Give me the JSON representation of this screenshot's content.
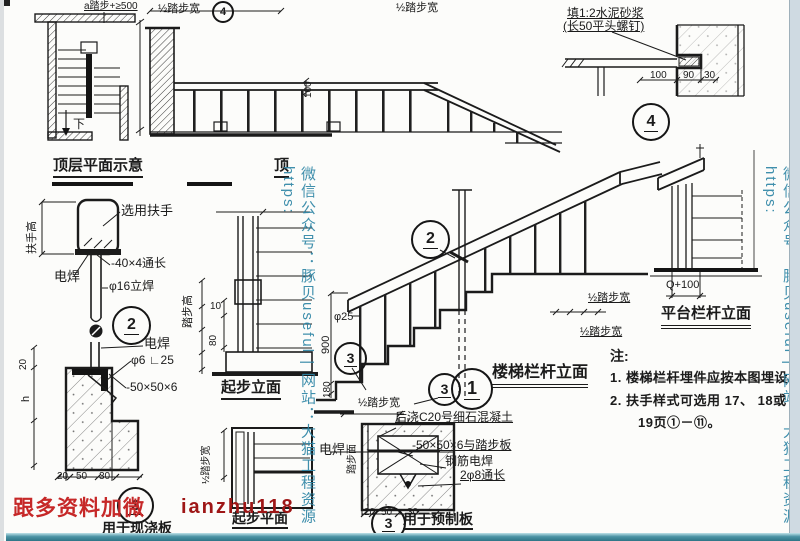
{
  "colors": {
    "ink": "#1b1b1b",
    "watermark_teal": "#2f86a6",
    "promo_red": "#c62828",
    "handle_red": "#9e1616",
    "bottom_bar": "#3f8496"
  },
  "watermark": {
    "text": "微信公众号：豚贝useful | 网站：大猫工程资源 https:"
  },
  "promo": {
    "text": "跟多资料加微",
    "handle": "ianzhu118"
  },
  "top_plan": {
    "title": "顶层平面示意",
    "note": "a踏步+≥500",
    "down": "下"
  },
  "top_elev": {
    "title": "顶",
    "tread_dim": "½踏步宽",
    "detail_ref": "4",
    "tread_dim2": "½踏步宽",
    "dim_100": "100"
  },
  "detail_4": {
    "ref": "4",
    "note_line1": "填1:2水泥砂浆",
    "note_line2": "(长50平头螺钉)",
    "dim_100": "100",
    "dim_90": "90",
    "dim_30": "30"
  },
  "detail_2": {
    "ref": "2",
    "handrail": "选用扶手",
    "height_dim": "扶手高",
    "weld": "电焊",
    "flat_bar": "-40×4通长",
    "post": "φ16立焊"
  },
  "detail_3_cast": {
    "ref": "3",
    "title": "用于现浇板",
    "weld": "电焊",
    "anchor": "φ6 ∟25",
    "angle": "-50×50×6",
    "dim_20": "20",
    "dim_50": "50",
    "dim_30": "30",
    "dim_left_20": "20",
    "dim_left_h": "h"
  },
  "start_elev": {
    "title": "起步立面",
    "dim_10": "10",
    "dim_80": "80",
    "riser_dim": "踏步高"
  },
  "start_plan": {
    "title": "起步平面",
    "tread_dim": "½踏步宽"
  },
  "main_elev": {
    "title": "楼梯栏杆立面",
    "ref_1": "1",
    "ref_2": "2",
    "ref_3a": "3",
    "ref_3b": "3",
    "dia": "φ25",
    "dim_900": "900",
    "dim_180": "180",
    "tread_dim_bottom": "½踏步宽",
    "tread_dim_r1": "½踏步宽",
    "tread_dim_r2": "½踏步宽"
  },
  "platform_elev": {
    "title": "平台栏杆立面",
    "dim": "Q+100"
  },
  "notes": {
    "heading": "注:",
    "line1": "1. 楼梯栏杆埋件应按本图埋设。",
    "line2": "2. 扶手样式可选用 17、 18或",
    "line3": "19页①－⑪。"
  },
  "detail_3_precast": {
    "ref": "3",
    "title": "用于预制板",
    "weld": "电焊",
    "face": "踏步面",
    "concrete": "后浇C20号细石混凝土",
    "angle": "-50×50×6与踏步板",
    "rebar_weld": "钢筋电焊",
    "rebar": "2φ8通长",
    "dim_20": "20",
    "dim_50": "50",
    "dim_30": "30"
  }
}
